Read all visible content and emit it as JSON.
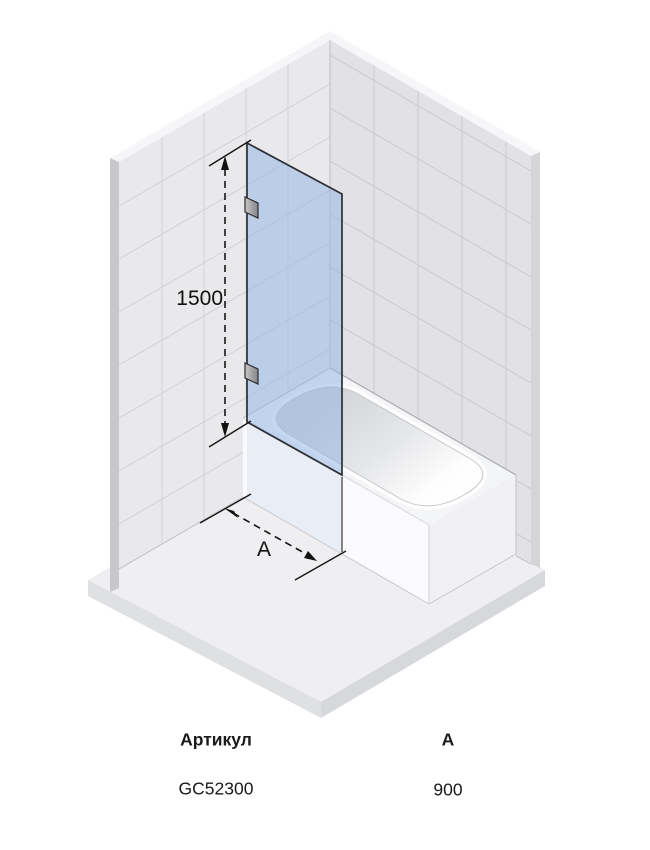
{
  "drawing": {
    "height_dimension": "1500",
    "width_dimension": "А",
    "glass_color": "rgba(152,182,229,0.55)",
    "glass_edge_color": "#2c2f34"
  },
  "table": {
    "header_article": "Артикул",
    "header_a": "А",
    "value_article": "GC52300",
    "value_a": "900"
  }
}
